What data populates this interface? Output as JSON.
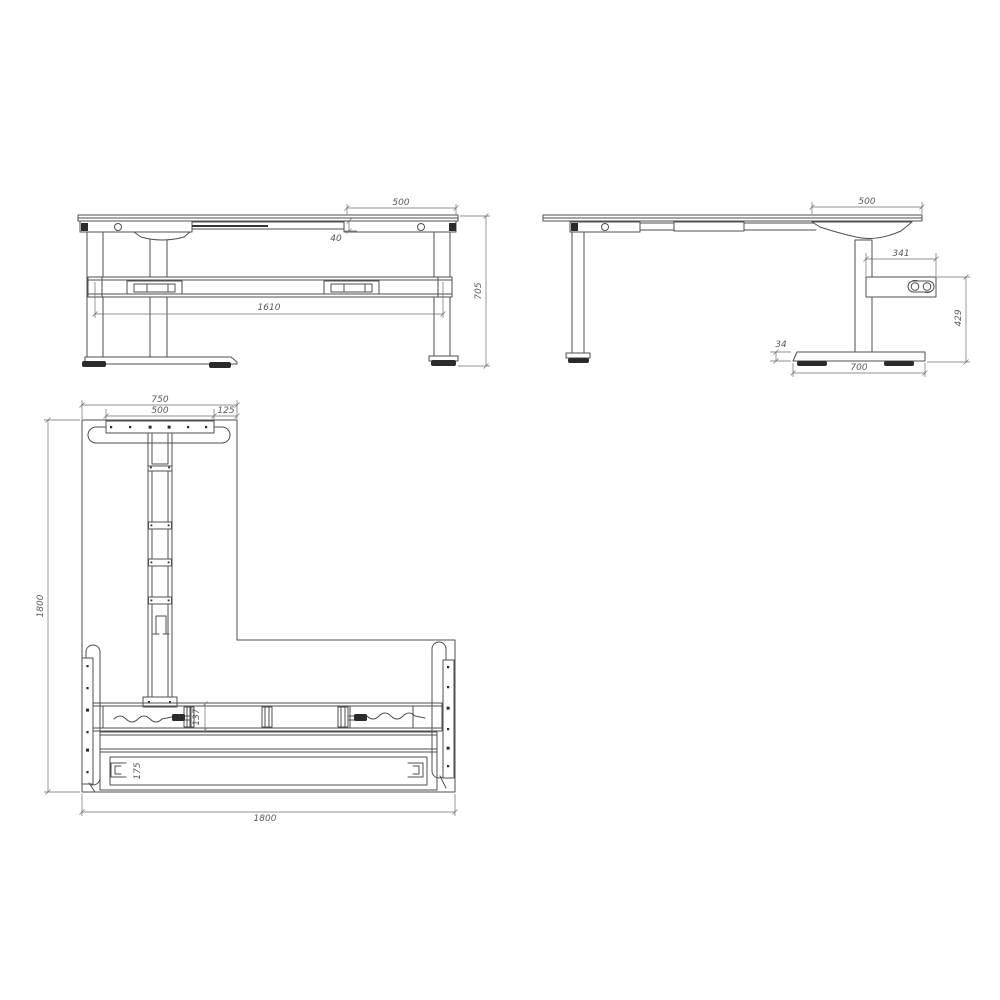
{
  "drawing": {
    "background_color": "#ffffff",
    "line_color": "#4f4f4f",
    "dimension_color": "#6e6e6e",
    "accent_fill": "#2b2b2b"
  },
  "front_view": {
    "dims": {
      "top_section_width": "500",
      "frame_inset": "40",
      "beam_length": "1610",
      "frame_height": "705"
    }
  },
  "side_view": {
    "dims": {
      "top_overhang": "500",
      "control_box_width": "341",
      "control_box_to_floor": "429",
      "foot_height": "34",
      "foot_length": "700"
    }
  },
  "plan_view": {
    "dims": {
      "top_foot_span": "750",
      "mounting_plate_width": "500",
      "corner_offset": "125",
      "overall_depth": "1800",
      "overall_width": "1800",
      "beam_width": "137",
      "rear_bar_width": "175"
    }
  }
}
